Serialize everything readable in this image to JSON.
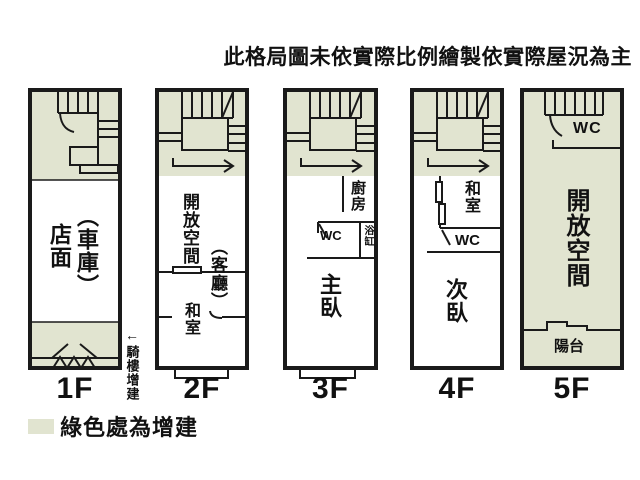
{
  "title": "此格局圖未依實際比例繪製依實際屋況為主",
  "colors": {
    "addition_green": "#e1e4d0",
    "wall": "#1a1a1a",
    "background": "#ffffff"
  },
  "legend": {
    "swatch_color": "#e1e4d0",
    "label": "綠色處為增建"
  },
  "annotation_1f": {
    "arrow": "←",
    "label": "騎樓增建"
  },
  "floors": [
    {
      "label": "1F",
      "rooms": {
        "storefront": "店面",
        "garage": "（車庫）"
      }
    },
    {
      "label": "2F",
      "rooms": {
        "open_space": "開放空間",
        "living_room": "（客廳）",
        "tatami_room": "和室"
      }
    },
    {
      "label": "3F",
      "rooms": {
        "kitchen": "廚房",
        "wc": "WC",
        "bathtub": "浴缸",
        "master_bedroom": "主臥"
      }
    },
    {
      "label": "4F",
      "rooms": {
        "tatami_room": "和室",
        "wc": "WC",
        "second_bedroom": "次臥"
      }
    },
    {
      "label": "5F",
      "rooms": {
        "wc": "WC",
        "open_space": "開放空間",
        "balcony": "陽台"
      }
    }
  ]
}
